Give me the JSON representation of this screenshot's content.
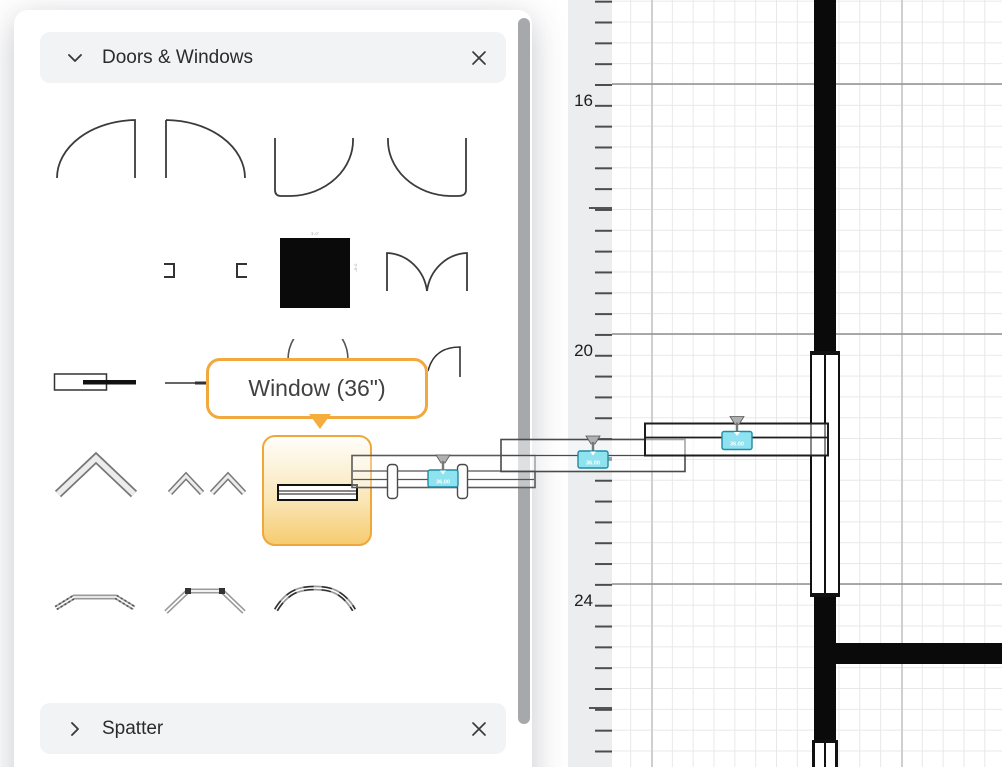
{
  "colors": {
    "accent_orange": "#F1A83C",
    "selection_gradient_bottom": "#F6CC70",
    "handle_teal_fill": "#8FE3F0",
    "handle_teal_border": "#1F8CA0",
    "wall_black": "#0A0A0A",
    "panel_header_bg": "#F2F3F5",
    "ruler_bg": "#EBEDEF"
  },
  "panel": {
    "sections": [
      {
        "label": "Doors & Windows",
        "state": "expanded"
      },
      {
        "label": "Spatter",
        "state": "collapsed"
      }
    ],
    "tooltip": {
      "text": "Window (36\")"
    },
    "selected_shape": "window-36",
    "column_dimensions": {
      "top": "3'-0\"",
      "side": "3'-0\""
    },
    "shapes": [
      "door-90-left",
      "door-90-right",
      "door-90-down-left",
      "door-90-down-right",
      "frame-end-left",
      "frame-end-right",
      "column-solid",
      "double-door",
      "pocket-door",
      "sliding-door",
      "arch-door",
      "corner-door",
      "bifold-door",
      "bifold-pair-door",
      "bifold-small-door",
      "window-36",
      "bay-window",
      "bay-window-angled",
      "bow-window"
    ]
  },
  "canvas": {
    "ruler": {
      "labels": [
        "16",
        "20",
        "24"
      ]
    },
    "drag_preview": {
      "dimension_label": "36.00",
      "count": 3
    }
  }
}
